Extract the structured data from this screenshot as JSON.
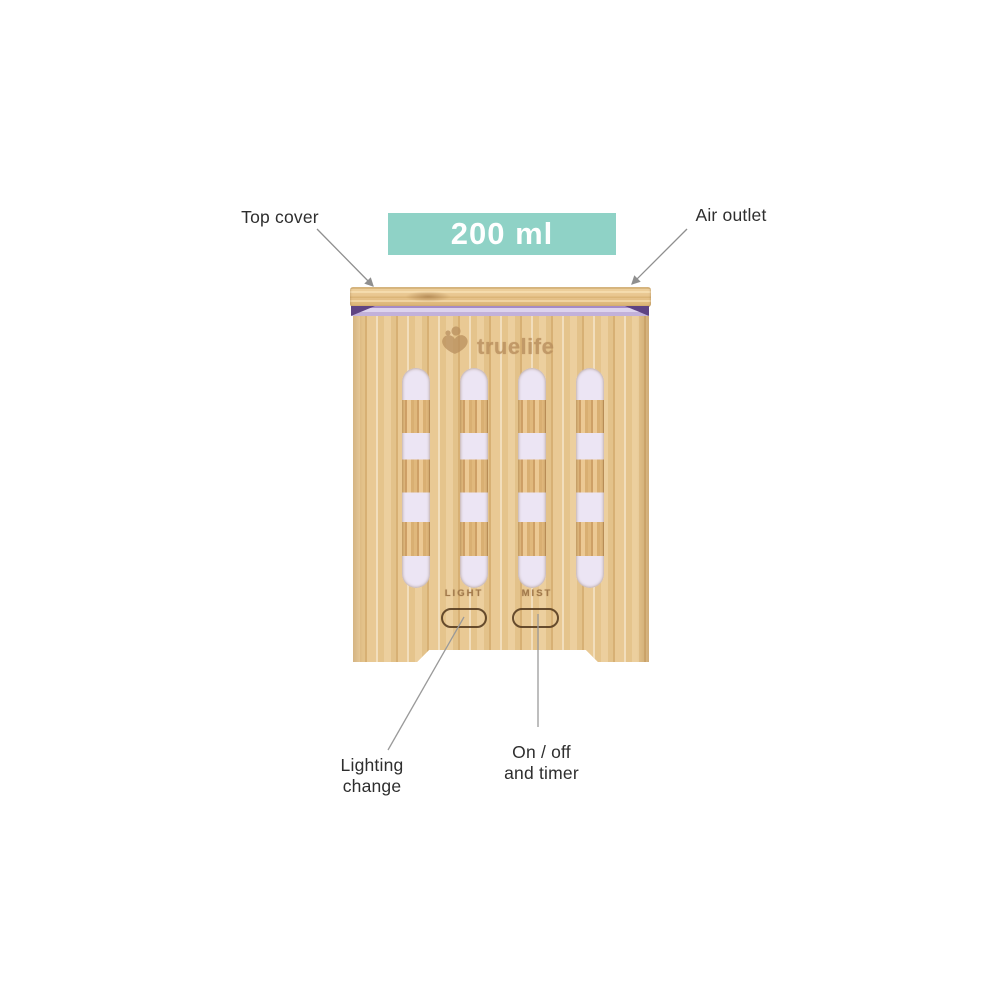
{
  "page": {
    "background": "#ffffff"
  },
  "badge": {
    "text": "200 ml",
    "bg_color": "#8fd2c6",
    "text_color": "#ffffff"
  },
  "callouts": {
    "top_cover": "Top cover",
    "air_outlet": "Air outlet",
    "lighting_change": {
      "line1": "Lighting",
      "line2": "change"
    },
    "on_off_timer": {
      "line1": "On / off",
      "line2": "and timer"
    }
  },
  "device": {
    "brand": "truelife",
    "logo_icon": "truelife-heart-figure-icon",
    "buttons": {
      "light": "LIGHT",
      "mist": "MIST"
    },
    "colors": {
      "wood": "#e8c791",
      "led_strip": "#c9bbe2",
      "led_strip_dark": "#5e4383",
      "slot_glow": "#ece5f4",
      "button_outline": "#4f351a",
      "engraving": "#b98f5e",
      "leader_line": "#8f8f8f",
      "label_text": "#2e2e2e"
    }
  }
}
